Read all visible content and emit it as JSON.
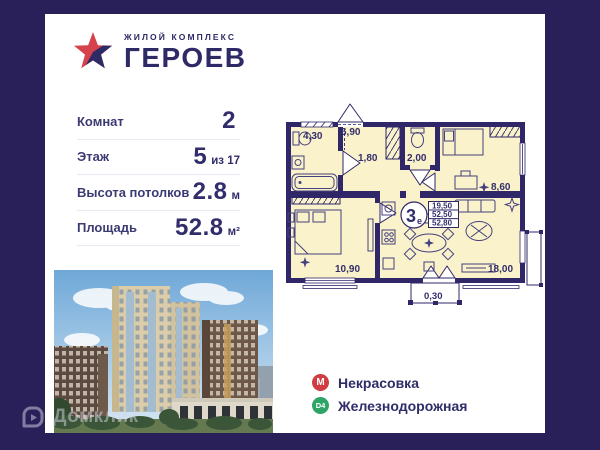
{
  "colors": {
    "background": "#2a2059",
    "card": "#ffffff",
    "brand_navy": "#2d2a66",
    "plan_wall": "#2f2768",
    "plan_room_fill": "#f9f2cb",
    "metro_red": "#d03c41",
    "d4_green": "#2ea567"
  },
  "logo": {
    "subtitle": "ЖИЛОЙ КОМПЛЕКС",
    "title": "ГЕРОЕВ"
  },
  "info": {
    "rows": [
      {
        "label": "Комнат",
        "value": "2",
        "suffix": ""
      },
      {
        "label": "Этаж",
        "value": "5",
        "suffix": "из 17"
      },
      {
        "label": "Высота потолков",
        "value": "2.8",
        "suffix": "м"
      },
      {
        "label": "Площадь",
        "value": "52.8",
        "suffix": "м²"
      }
    ]
  },
  "plan": {
    "type_number": "3",
    "type_letter": "е",
    "areas_table": [
      "19,50",
      "52,50",
      "52,80"
    ],
    "rooms": [
      {
        "name": "hall",
        "area": "6,90"
      },
      {
        "name": "bathroom",
        "area": "4,30"
      },
      {
        "name": "wardrobe",
        "area": "1,80"
      },
      {
        "name": "wc",
        "area": "2,00"
      },
      {
        "name": "bedroom-2",
        "area": "8,60"
      },
      {
        "name": "bedroom-1",
        "area": "10,90"
      },
      {
        "name": "kitchen-living",
        "area": "18,00"
      },
      {
        "name": "balcony",
        "area": "0,30"
      }
    ]
  },
  "transit": [
    {
      "badge": "М",
      "name": "Некрасовка"
    },
    {
      "badge": "D4",
      "name": "Железнодорожная"
    }
  ],
  "watermark": {
    "text": "Домклик"
  }
}
